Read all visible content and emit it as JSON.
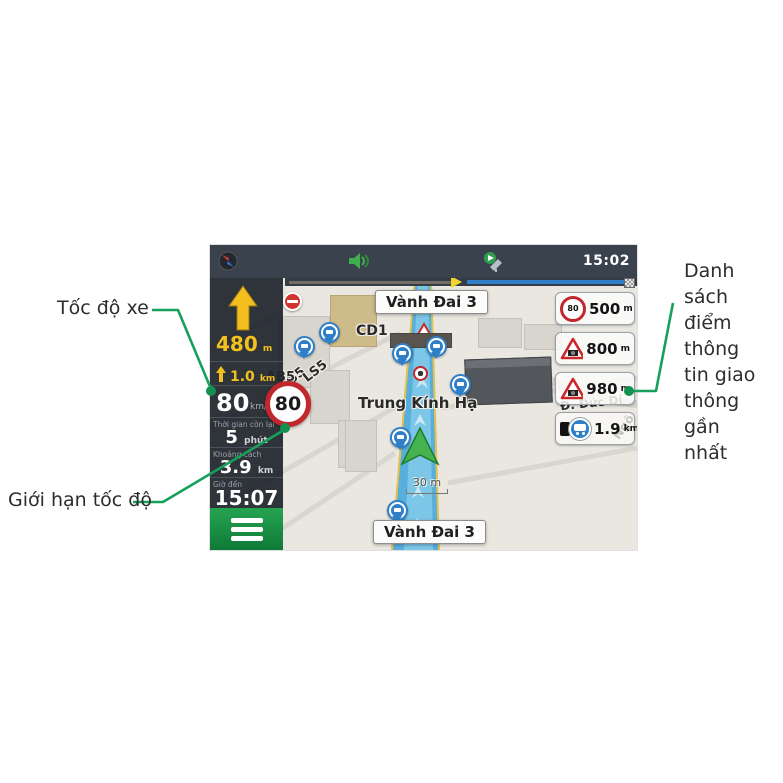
{
  "annotations": {
    "vehicle_speed": "Tốc độ xe",
    "speed_limit": "Giới hạn tốc độ",
    "traffic_list_lines": [
      "Danh sách",
      "điểm thông",
      "tin giao",
      "thông gần",
      "nhất"
    ],
    "line_color": "#17a05a"
  },
  "nav": {
    "statusbar": {
      "time": "15:02"
    },
    "sidebar": {
      "next_distance": "480",
      "next_unit": "m",
      "lane_distance": "1.0",
      "lane_unit": "km",
      "speed": "80",
      "speed_unit": "km/h",
      "limit": "80",
      "rows": [
        {
          "label": "Thời gian còn lại",
          "value": "5",
          "unit": "phút"
        },
        {
          "label": "Khoảng cách",
          "value": "3.9",
          "unit": "km"
        },
        {
          "label": "Giờ đến",
          "value": "15:07",
          "unit": ""
        }
      ]
    },
    "map": {
      "street_top": "Vành Đai 3",
      "street_bottom": "Vành Đai 3",
      "cd1": "CD1",
      "ls5a": "LS5",
      "ls5b": "LS5",
      "ab5": "AB5",
      "district": "Trung Kính Hạ",
      "duc_di": "Đ. Đức Di",
      "ngo": "Ngõ",
      "scale": "30 m"
    },
    "traffic_items": [
      {
        "sign": "80",
        "distance": "500",
        "unit": "m"
      },
      {
        "distance": "800",
        "unit": "m"
      },
      {
        "distance": "980",
        "unit": "m"
      },
      {
        "distance": "1.9",
        "unit": "km"
      }
    ]
  }
}
